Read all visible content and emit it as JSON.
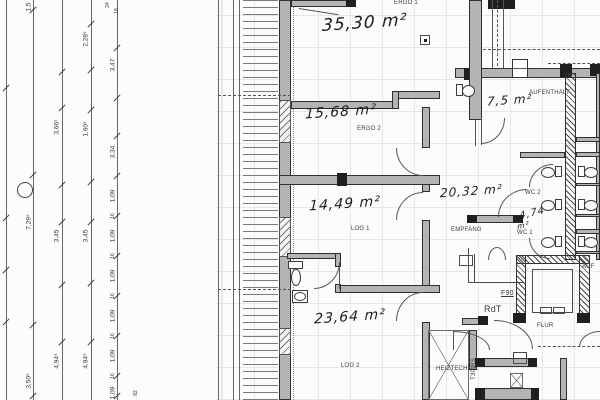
{
  "drawing": {
    "type": "architectural-floor-plan-scan",
    "colors": {
      "paper": "#fcfcfa",
      "ink": "#3a3a3a",
      "wall_fill": "#b4b4b4",
      "grid": "#e2e2e2",
      "handwriting": "#1d1d1d"
    }
  },
  "printed_labels": [
    {
      "name": "room-label-ergo1",
      "text": "ERGO 1",
      "x": 394,
      "y": 0
    },
    {
      "name": "room-label-ergo2",
      "text": "ERGO 2",
      "x": 357,
      "y": 126
    },
    {
      "name": "room-label-log1",
      "text": "LOG 1",
      "x": 351,
      "y": 226
    },
    {
      "name": "room-label-log2",
      "text": "LOG 2",
      "x": 341,
      "y": 363
    },
    {
      "name": "room-label-aufenthalt",
      "text": "AUFENTHALT",
      "x": 529,
      "y": 90
    },
    {
      "name": "room-label-empfang",
      "text": "EMPFANG",
      "x": 451,
      "y": 227
    },
    {
      "name": "room-label-wc2",
      "text": "WC 2",
      "x": 525,
      "y": 190
    },
    {
      "name": "room-label-wc1",
      "text": "WC 1",
      "x": 517,
      "y": 230
    },
    {
      "name": "corridor-label-flur",
      "text": "FLUR",
      "x": 537,
      "y": 323
    },
    {
      "name": "door-label-f90",
      "text": "F90",
      "x": 501,
      "y": 290,
      "underline": true,
      "size": 7
    },
    {
      "name": "door-label-rdt",
      "text": "RdT",
      "x": 484,
      "y": 304,
      "size": 9
    },
    {
      "name": "door-label-t30rs",
      "text": "T30-RS",
      "x": 471,
      "y": 358,
      "vertical": true
    },
    {
      "name": "elevator-label-auf",
      "text": "AUF",
      "x": 582,
      "y": 264
    },
    {
      "name": "room-label-heiztechnik",
      "text": "HEIZTECHNIK",
      "x": 436,
      "y": 366
    }
  ],
  "handwritten_areas": [
    {
      "name": "area-ergo1",
      "text": "35,30 m²",
      "x": 322,
      "y": 13,
      "size": 17
    },
    {
      "name": "area-ergo2",
      "text": "15,68 m²",
      "x": 305,
      "y": 104,
      "size": 14
    },
    {
      "name": "area-log1",
      "text": "14,49 m²",
      "x": 309,
      "y": 196,
      "size": 14
    },
    {
      "name": "area-log2",
      "text": "23,64 m²",
      "x": 314,
      "y": 309,
      "size": 14
    },
    {
      "name": "area-hall",
      "text": "20,32 m²",
      "x": 440,
      "y": 184,
      "size": 12
    },
    {
      "name": "area-aufenthalt",
      "text": "7,5 m²",
      "x": 487,
      "y": 93,
      "size": 12
    },
    {
      "name": "area-wc1",
      "text": "4,74",
      "x": 519,
      "y": 208,
      "size": 10,
      "rot": -14
    },
    {
      "name": "area-wc1-unit",
      "text": "m²",
      "x": 517,
      "y": 221,
      "size": 8,
      "rot": -14
    }
  ],
  "dimensions": [
    {
      "text": "1,5",
      "x": 29,
      "y": 7
    },
    {
      "text": "7,29⁵",
      "x": 29,
      "y": 222
    },
    {
      "text": "3,50⁵",
      "x": 29,
      "y": 381
    },
    {
      "text": "3,66⁵",
      "x": 57,
      "y": 127
    },
    {
      "text": "3,45",
      "x": 57,
      "y": 236
    },
    {
      "text": "4,94⁵",
      "x": 57,
      "y": 361
    },
    {
      "text": "2,28⁵",
      "x": 86,
      "y": 39
    },
    {
      "text": "1,60⁵",
      "x": 86,
      "y": 129
    },
    {
      "text": "3,45",
      "x": 86,
      "y": 236
    },
    {
      "text": "4,94⁵",
      "x": 86,
      "y": 361
    },
    {
      "text": "24",
      "x": 108,
      "y": 5,
      "size": 5
    },
    {
      "text": "18",
      "x": 117,
      "y": 11,
      "size": 5
    },
    {
      "text": "3,47",
      "x": 113,
      "y": 65
    },
    {
      "text": "3,34",
      "x": 113,
      "y": 152
    },
    {
      "text": "1,09",
      "x": 113,
      "y": 196
    },
    {
      "text": "16",
      "x": 113,
      "y": 216,
      "size": 5
    },
    {
      "text": "1,09",
      "x": 113,
      "y": 236
    },
    {
      "text": "16",
      "x": 113,
      "y": 256,
      "size": 5
    },
    {
      "text": "1,09",
      "x": 113,
      "y": 276
    },
    {
      "text": "16",
      "x": 113,
      "y": 296,
      "size": 5
    },
    {
      "text": "1,09",
      "x": 113,
      "y": 316
    },
    {
      "text": "16",
      "x": 113,
      "y": 336,
      "size": 5
    },
    {
      "text": "1,09",
      "x": 113,
      "y": 356
    },
    {
      "text": "16",
      "x": 113,
      "y": 376,
      "size": 5
    },
    {
      "text": "1,09",
      "x": 113,
      "y": 393
    },
    {
      "text": "82",
      "x": 136,
      "y": 393,
      "size": 5
    }
  ]
}
